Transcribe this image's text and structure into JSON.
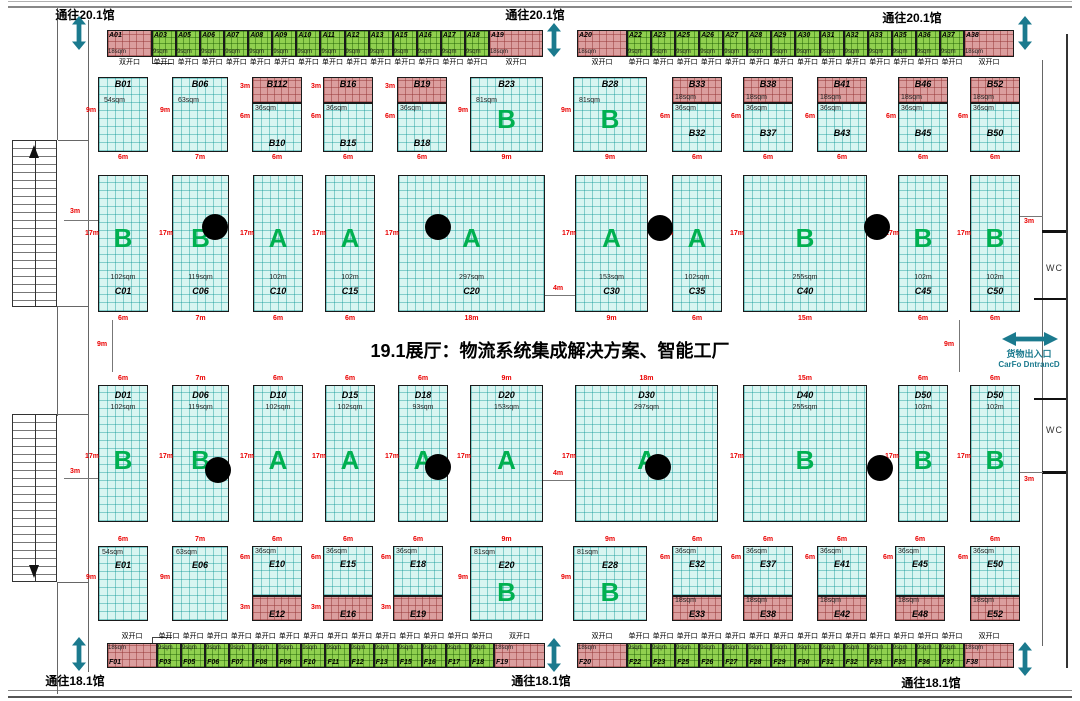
{
  "title": "19.1展厅：物流系统集成解决方案、智能工厂",
  "labels": {
    "to_upper_hall": "通往20.1馆",
    "to_lower_hall": "通往18.1馆",
    "wc": "WC",
    "cargo_line1": "货物出入口",
    "cargo_line2": "CarFo DntrancD",
    "single_opening": "单开口",
    "double_opening": "双开口"
  },
  "colors": {
    "green_booth": "#90d04f",
    "pink_booth": "#db9e9e",
    "cyan_booth": "#d8f5f1",
    "zone_letter": "#00b050",
    "dimension_red": "#ea0000",
    "arrow_teal": "#1b7a8e"
  },
  "top_strip": {
    "y": 30,
    "h": 27,
    "open_y": 59,
    "segments": [
      {
        "start": 107,
        "items": [
          {
            "id": "A01",
            "kind": "pink",
            "sqm": "18sqm",
            "w": 45,
            "opening": "双开口"
          },
          {
            "ids": [
              "A03",
              "A05",
              "A06",
              "A07",
              "A08",
              "A09",
              "A10",
              "A11",
              "A12",
              "A13",
              "A15",
              "A16",
              "A17",
              "A18"
            ],
            "kind": "green",
            "sqm": "9sqm",
            "w": 24.07,
            "opening": "单开口"
          },
          {
            "id": "A19",
            "kind": "pink",
            "sqm": "18sqm",
            "w": 54,
            "opening": "双开口"
          }
        ]
      },
      {
        "start": 577,
        "items": [
          {
            "id": "A20",
            "kind": "pink",
            "sqm": "18sqm",
            "w": 50,
            "opening": "双开口"
          },
          {
            "ids": [
              "A22",
              "A23",
              "A25",
              "A26",
              "A27",
              "A28",
              "A29",
              "A30",
              "A31",
              "A32",
              "A33",
              "A35",
              "A36",
              "A37"
            ],
            "kind": "green",
            "sqm": "9sqm",
            "w": 24.07,
            "opening": "单开口"
          },
          {
            "id": "A38",
            "kind": "pink",
            "sqm": "18sqm",
            "w": 50,
            "opening": "双开口"
          }
        ]
      }
    ]
  },
  "bottom_strip": {
    "y": 643,
    "h": 25,
    "open_y": 633,
    "segments": [
      {
        "start": 107,
        "items": [
          {
            "id": "F01",
            "kind": "pink",
            "sqm": "18sqm",
            "w": 50,
            "opening": "双开口"
          },
          {
            "ids": [
              "F03",
              "F05",
              "F06",
              "F07",
              "F08",
              "F09",
              "F10",
              "F11",
              "F12",
              "F13",
              "F15",
              "F16",
              "F17",
              "F18"
            ],
            "kind": "green",
            "sqm": "9sqm",
            "w": 24.07,
            "opening": "单开口"
          },
          {
            "id": "F19",
            "kind": "pink",
            "sqm": "18sqm",
            "w": 51,
            "opening": "双开口"
          }
        ]
      },
      {
        "start": 577,
        "items": [
          {
            "id": "F20",
            "kind": "pink",
            "sqm": "18sqm",
            "w": 50,
            "opening": "双开口"
          },
          {
            "ids": [
              "F22",
              "F23",
              "F25",
              "F26",
              "F27",
              "F28",
              "F29",
              "F30",
              "F31",
              "F32",
              "F33",
              "F35",
              "F36",
              "F37"
            ],
            "kind": "green",
            "sqm": "9sqm",
            "w": 24.07,
            "opening": "单开口"
          },
          {
            "id": "F38",
            "kind": "pink",
            "sqm": "18sqm",
            "w": 50,
            "opening": "双开口"
          }
        ]
      }
    ]
  },
  "row_b": {
    "y": 77,
    "h": 75,
    "pink_h": 26,
    "booths": [
      {
        "type": "open",
        "id": "B01",
        "sqm": "54sqm",
        "x": 98,
        "w": 50,
        "side": "9m",
        "size": "6m"
      },
      {
        "type": "open",
        "id": "B06",
        "sqm": "63sqm",
        "x": 172,
        "w": 56,
        "side": "9m",
        "size": "7m"
      },
      {
        "type": "split",
        "pid": "B112",
        "cid": "B10",
        "psqm": "",
        "csqm": "36sqm",
        "x": 252,
        "w": 50,
        "pside": "3m",
        "cside": "6m",
        "size": "6m",
        "cpos": "bottom"
      },
      {
        "type": "split",
        "pid": "B16",
        "cid": "B15",
        "psqm": "",
        "csqm": "36sqm",
        "x": 323,
        "w": 50,
        "pside": "3m",
        "cside": "6m",
        "size": "6m",
        "cpos": "bottom"
      },
      {
        "type": "split",
        "pid": "B19",
        "cid": "B18",
        "psqm": "",
        "csqm": "36sqm",
        "x": 397,
        "w": 50,
        "pside": "3m",
        "cside": "6m",
        "size": "6m",
        "cpos": "bottom"
      },
      {
        "type": "big",
        "id": "B23",
        "sqm": "81sqm",
        "letter": "B",
        "x": 470,
        "w": 73,
        "side": "9m",
        "size": "9m"
      },
      {
        "type": "big",
        "id": "B28",
        "sqm": "81sqm",
        "letter": "B",
        "x": 573,
        "w": 74,
        "side": "9m",
        "size": "9m"
      },
      {
        "type": "split",
        "pid": "B33",
        "cid": "B32",
        "psqm": "18sqm",
        "csqm": "36sqm",
        "x": 672,
        "w": 50,
        "pside": "",
        "cside": "6m",
        "size": "6m",
        "cpos": "mid"
      },
      {
        "type": "split",
        "pid": "B38",
        "cid": "B37",
        "psqm": "18sqm",
        "csqm": "36sqm",
        "x": 743,
        "w": 50,
        "pside": "",
        "cside": "6m",
        "size": "6m",
        "cpos": "mid"
      },
      {
        "type": "split",
        "pid": "B41",
        "cid": "B43",
        "psqm": "18sqm",
        "csqm": "36sqm",
        "x": 817,
        "w": 50,
        "pside": "",
        "cside": "6m",
        "size": "6m",
        "cpos": "mid"
      },
      {
        "type": "split",
        "pid": "B46",
        "cid": "B45",
        "psqm": "18sqm",
        "csqm": "36sqm",
        "x": 898,
        "w": 50,
        "pside": "",
        "cside": "6m",
        "size": "6m",
        "cpos": "mid"
      },
      {
        "type": "split",
        "pid": "B52",
        "cid": "B50",
        "psqm": "18sqm",
        "csqm": "36sqm",
        "x": 970,
        "w": 50,
        "pside": "",
        "cside": "6m",
        "size": "6m",
        "cpos": "mid"
      }
    ]
  },
  "row_c": {
    "y": 175,
    "h": 137,
    "booths": [
      {
        "id": "C01",
        "letter": "B",
        "sqm": "102sqm",
        "x": 98,
        "w": 50,
        "side": "17m",
        "size": "6m"
      },
      {
        "id": "C06",
        "letter": "B",
        "sqm": "119sqm",
        "x": 172,
        "w": 57,
        "side": "17m",
        "size": "7m"
      },
      {
        "id": "C10",
        "letter": "A",
        "sqm": "102m",
        "x": 253,
        "w": 50,
        "side": "17m",
        "size": "6m"
      },
      {
        "id": "C15",
        "letter": "A",
        "sqm": "102m",
        "x": 325,
        "w": 50,
        "side": "17m",
        "size": "6m"
      },
      {
        "id": "C20",
        "letter": "A",
        "sqm": "297sqm",
        "x": 398,
        "w": 147,
        "side": "17m",
        "size": "18m"
      },
      {
        "id": "C30",
        "letter": "A",
        "sqm": "153sqm",
        "x": 575,
        "w": 73,
        "side": "17m",
        "size": "9m"
      },
      {
        "id": "C35",
        "letter": "A",
        "sqm": "102sqm",
        "x": 672,
        "w": 50,
        "side": "17m",
        "size": "6m"
      },
      {
        "id": "C40",
        "letter": "B",
        "sqm": "255sqm",
        "x": 743,
        "w": 124,
        "side": "17m",
        "size": "15m"
      },
      {
        "id": "C45",
        "letter": "B",
        "sqm": "102m",
        "x": 898,
        "w": 50,
        "side": "17m",
        "size": "6m"
      },
      {
        "id": "C50",
        "letter": "B",
        "sqm": "102m",
        "x": 970,
        "w": 50,
        "side": "17m",
        "size": "6m"
      }
    ]
  },
  "row_d": {
    "y": 385,
    "h": 137,
    "booths": [
      {
        "id": "D01",
        "letter": "B",
        "sqm": "102sqm",
        "x": 98,
        "w": 50,
        "side": "17m",
        "size": "6m"
      },
      {
        "id": "D06",
        "letter": "B",
        "sqm": "119sqm",
        "x": 172,
        "w": 57,
        "side": "17m",
        "size": "7m"
      },
      {
        "id": "D10",
        "letter": "A",
        "sqm": "102sqm",
        "x": 253,
        "w": 50,
        "side": "17m",
        "size": "6m"
      },
      {
        "id": "D15",
        "letter": "A",
        "sqm": "102sqm",
        "x": 325,
        "w": 50,
        "side": "17m",
        "size": "6m"
      },
      {
        "id": "D18",
        "letter": "A",
        "sqm": "93sqm",
        "x": 398,
        "w": 50,
        "side": "17m",
        "size": "6m"
      },
      {
        "id": "D20",
        "letter": "A",
        "sqm": "153sqm",
        "x": 470,
        "w": 73,
        "side": "17m",
        "size": "9m"
      },
      {
        "id": "D30",
        "letter": "A",
        "sqm": "297sqm",
        "x": 575,
        "w": 143,
        "side": "17m",
        "size": "18m"
      },
      {
        "id": "D40",
        "letter": "B",
        "sqm": "255sqm",
        "x": 743,
        "w": 124,
        "side": "17m",
        "size": "15m"
      },
      {
        "id": "D50",
        "letter": "B",
        "sqm": "102m",
        "x": 898,
        "w": 50,
        "side": "17m",
        "size": "6m"
      },
      {
        "id": "D50",
        "letter": "B",
        "sqm": "102m",
        "x": 970,
        "w": 50,
        "side": "17m",
        "size": "6m"
      }
    ]
  },
  "row_e": {
    "y": 546,
    "h": 75,
    "pink_h": 25,
    "booths": [
      {
        "type": "open",
        "id": "E01",
        "sqm": "54sqm",
        "x": 98,
        "w": 50,
        "side": "9m",
        "size": "6m"
      },
      {
        "type": "open",
        "id": "E06",
        "sqm": "63sqm",
        "x": 172,
        "w": 56,
        "side": "9m",
        "size": "7m"
      },
      {
        "type": "split",
        "cid": "E10",
        "pid": "E12",
        "csqm": "36sqm",
        "psqm": "",
        "x": 252,
        "w": 50,
        "cside": "6m",
        "pside": "3m",
        "size": "6m"
      },
      {
        "type": "split",
        "cid": "E15",
        "pid": "E16",
        "csqm": "36sqm",
        "psqm": "",
        "x": 323,
        "w": 50,
        "cside": "6m",
        "pside": "3m",
        "size": "6m"
      },
      {
        "type": "split",
        "cid": "E18",
        "pid": "E19",
        "csqm": "36sqm",
        "psqm": "",
        "x": 393,
        "w": 50,
        "cside": "6m",
        "pside": "3m",
        "size": "6m"
      },
      {
        "type": "big",
        "id": "E20",
        "sqm": "81sqm",
        "letter": "B",
        "x": 470,
        "w": 73,
        "side": "9m",
        "size": "9m"
      },
      {
        "type": "big",
        "id": "E28",
        "sqm": "81sqm",
        "letter": "B",
        "x": 573,
        "w": 74,
        "side": "9m",
        "size": "9m"
      },
      {
        "type": "split",
        "cid": "E32",
        "pid": "E33",
        "csqm": "36sqm",
        "psqm": "18sqm",
        "x": 672,
        "w": 50,
        "cside": "6m",
        "pside": "",
        "size": "6m"
      },
      {
        "type": "split",
        "cid": "E37",
        "pid": "E38",
        "csqm": "36sqm",
        "psqm": "18sqm",
        "x": 743,
        "w": 50,
        "cside": "6m",
        "pside": "",
        "size": "6m"
      },
      {
        "type": "split",
        "cid": "E41",
        "pid": "E42",
        "csqm": "36sqm",
        "psqm": "18sqm",
        "x": 817,
        "w": 50,
        "cside": "6m",
        "pside": "",
        "size": "6m"
      },
      {
        "type": "split",
        "cid": "E45",
        "pid": "E48",
        "csqm": "36sqm",
        "psqm": "18sqm",
        "x": 895,
        "w": 50,
        "cside": "6m",
        "pside": "",
        "size": "6m"
      },
      {
        "type": "split",
        "cid": "E50",
        "pid": "E52",
        "csqm": "36sqm",
        "psqm": "18sqm",
        "x": 970,
        "w": 50,
        "cside": "6m",
        "pside": "",
        "size": "6m"
      }
    ]
  },
  "pillars": [
    [
      215,
      227
    ],
    [
      438,
      227
    ],
    [
      660,
      228
    ],
    [
      877,
      227
    ],
    [
      218,
      470
    ],
    [
      438,
      467
    ],
    [
      658,
      467
    ],
    [
      880,
      468
    ]
  ],
  "markers": [
    {
      "t": "3m",
      "x": 70,
      "y": 208
    },
    {
      "t": "3m",
      "x": 70,
      "y": 468
    },
    {
      "t": "3m",
      "x": 1024,
      "y": 218
    },
    {
      "t": "3m",
      "x": 1024,
      "y": 476
    },
    {
      "t": "9m",
      "x": 97,
      "y": 341
    },
    {
      "t": "9m",
      "x": 944,
      "y": 341
    },
    {
      "t": "4m",
      "x": 553,
      "y": 285
    },
    {
      "t": "4m",
      "x": 553,
      "y": 470
    }
  ],
  "marker_lines": [
    [
      64,
      220,
      34,
      1
    ],
    [
      64,
      478,
      34,
      1
    ],
    [
      1020,
      216,
      23,
      1
    ],
    [
      1020,
      472,
      23,
      1
    ],
    [
      112,
      320,
      1,
      52
    ],
    [
      959,
      320,
      1,
      52
    ],
    [
      545,
      295,
      30,
      1
    ],
    [
      543,
      480,
      32,
      1
    ]
  ]
}
